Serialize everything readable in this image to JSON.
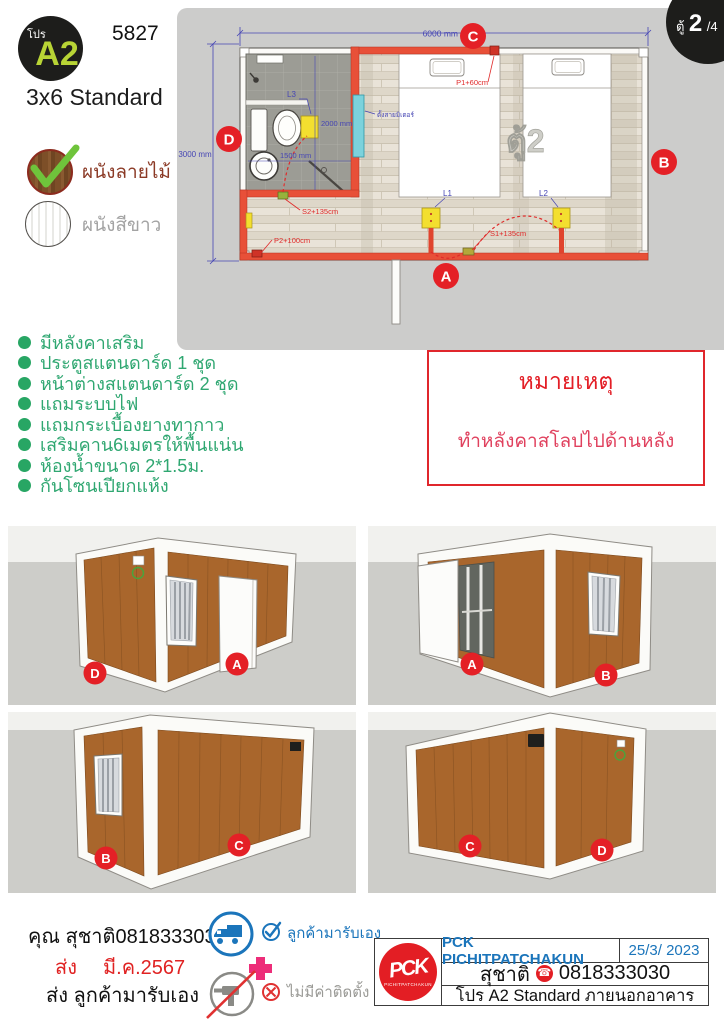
{
  "header": {
    "logo_prefix": "โปร",
    "logo_main": "A2",
    "code": "5827",
    "model": "3x6 Standard",
    "wood_label": "ผนังลายไม้",
    "white_label": "ผนังสีขาว"
  },
  "plan": {
    "badge_prefix": "ตู้",
    "badge_num": "2",
    "badge_suffix": "/4",
    "watermark": "ตู้2",
    "dims": {
      "width": "6000 mm",
      "height": "3000 mm",
      "bath_width": "2000 mm",
      "bath_depth": "1500 mm"
    },
    "labels": {
      "meter": "ตั้งสายมิเตอร์",
      "l1": "L1",
      "l2": "L2",
      "l3": "L3",
      "p1": "P1+60cm",
      "p2": "P2+100cm",
      "s1": "S1+135cm",
      "s2": "S2+135cm"
    },
    "corners": {
      "a": "A",
      "b": "B",
      "c": "C",
      "d": "D"
    }
  },
  "features": {
    "items": [
      "มีหลังคาเสริม",
      "ประตูสแตนดาร์ด 1 ชุด",
      "หน้าต่างสแตนดาร์ด 2 ชุด",
      "แถมระบบไฟ",
      "แถมกระเบื้องยางทากาว",
      "เสริมคาน6เมตรให้พื้นแน่น",
      "ห้องน้ำขนาด 2*1.5ม.",
      "กันโซนเปียกแห้ง"
    ]
  },
  "note": {
    "title": "หมายเหตุ",
    "body": "ทำหลังคาสโลปไปด้านหลัง"
  },
  "views": {
    "tl_left": "D",
    "tl_right": "A",
    "tr_left": "A",
    "tr_right": "B",
    "bl_left": "B",
    "bl_right": "C",
    "br_left": "C",
    "br_right": "D"
  },
  "footer": {
    "contact": "คุณ สุชาติ0818333030",
    "ship_label": "ส่ง",
    "ship_date": "มี.ค.2567",
    "pickup_line": "ส่ง ลูกค้ามารับเอง",
    "pickup_note": "ลูกค้ามารับเอง",
    "no_install_note": "ไม่มีค่าติดตั้ง",
    "company": "PCK PICHITPATCHAKUN",
    "doc_date": "25/3/ 2023",
    "contact_name": "สุชาติ",
    "phone": "0818333030",
    "product_line": "โปร A2 Standard ภายนอกอาคาร",
    "logo_monogram": "PCK",
    "logo_banner": "PICHITPATCHAKUN"
  },
  "colors": {
    "accent_red": "#e42026",
    "green": "#28a664",
    "blue": "#1b75bb",
    "dim_blue": "#4646b4",
    "wall_red": "#e85038",
    "wood_brown": "#a9662c"
  }
}
